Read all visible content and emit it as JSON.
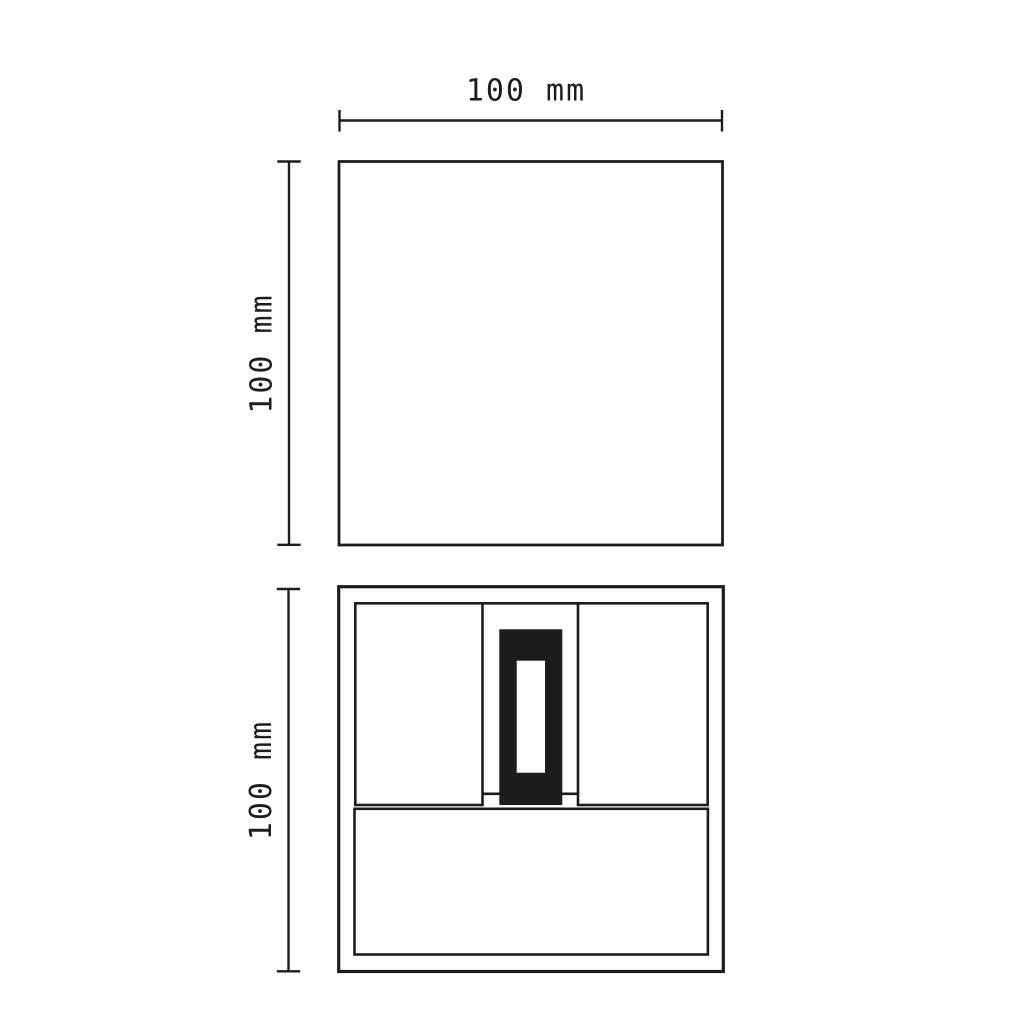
{
  "drawing": {
    "background_color": "#ffffff",
    "line_color": "#1d1d1b",
    "fill_color": "#1d1d1b",
    "dimensions": {
      "top_width": {
        "label": "100 mm",
        "orientation": "horizontal"
      },
      "top_height": {
        "label": "100 mm",
        "orientation": "vertical"
      },
      "bottom_height": {
        "label": "100 mm",
        "orientation": "vertical"
      }
    }
  }
}
